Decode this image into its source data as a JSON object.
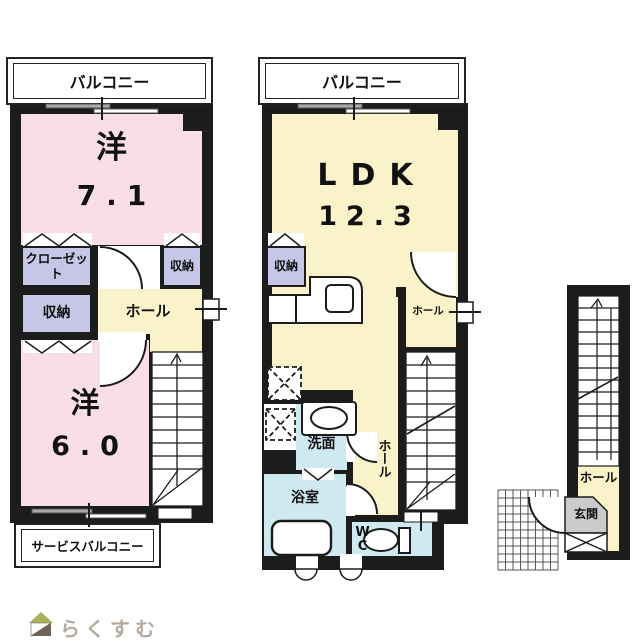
{
  "colors": {
    "room_pink": "#f9dee9",
    "room_yellow": "#faf3c9",
    "closet_lavender": "#c6c6e6",
    "sanitary_blue": "#cfe9f1",
    "entrance_gray": "#cbcbcb",
    "wall_black": "#1c1c1c",
    "logo_green": "#a7b257",
    "logo_brown": "#6e625b",
    "logo_text_color": "#b5aaa0"
  },
  "upper_floor_left": {
    "balcony_label": "バルコニー",
    "western_room_1_name": "洋",
    "western_room_1_size": "7.1",
    "closet_label": "クローゼット",
    "storage_label_1": "収納",
    "storage_label_2": "収納",
    "hall_label": "ホール",
    "western_room_2_name": "洋",
    "western_room_2_size": "6.0",
    "service_balcony_label": "サービスバルコニー"
  },
  "upper_floor_right": {
    "balcony_label": "バルコニー",
    "ldk_name": "LDK",
    "ldk_size": "12.3",
    "storage_label": "収納",
    "hall_upper_label": "ホール",
    "hall_lower_label": "ホール",
    "washroom_label": "洗面",
    "bathroom_label": "浴室",
    "wc_label": "WC"
  },
  "ground_floor": {
    "hall_label": "ホール",
    "entrance_label": "玄関"
  },
  "footer": {
    "brand": "らくすむ"
  }
}
